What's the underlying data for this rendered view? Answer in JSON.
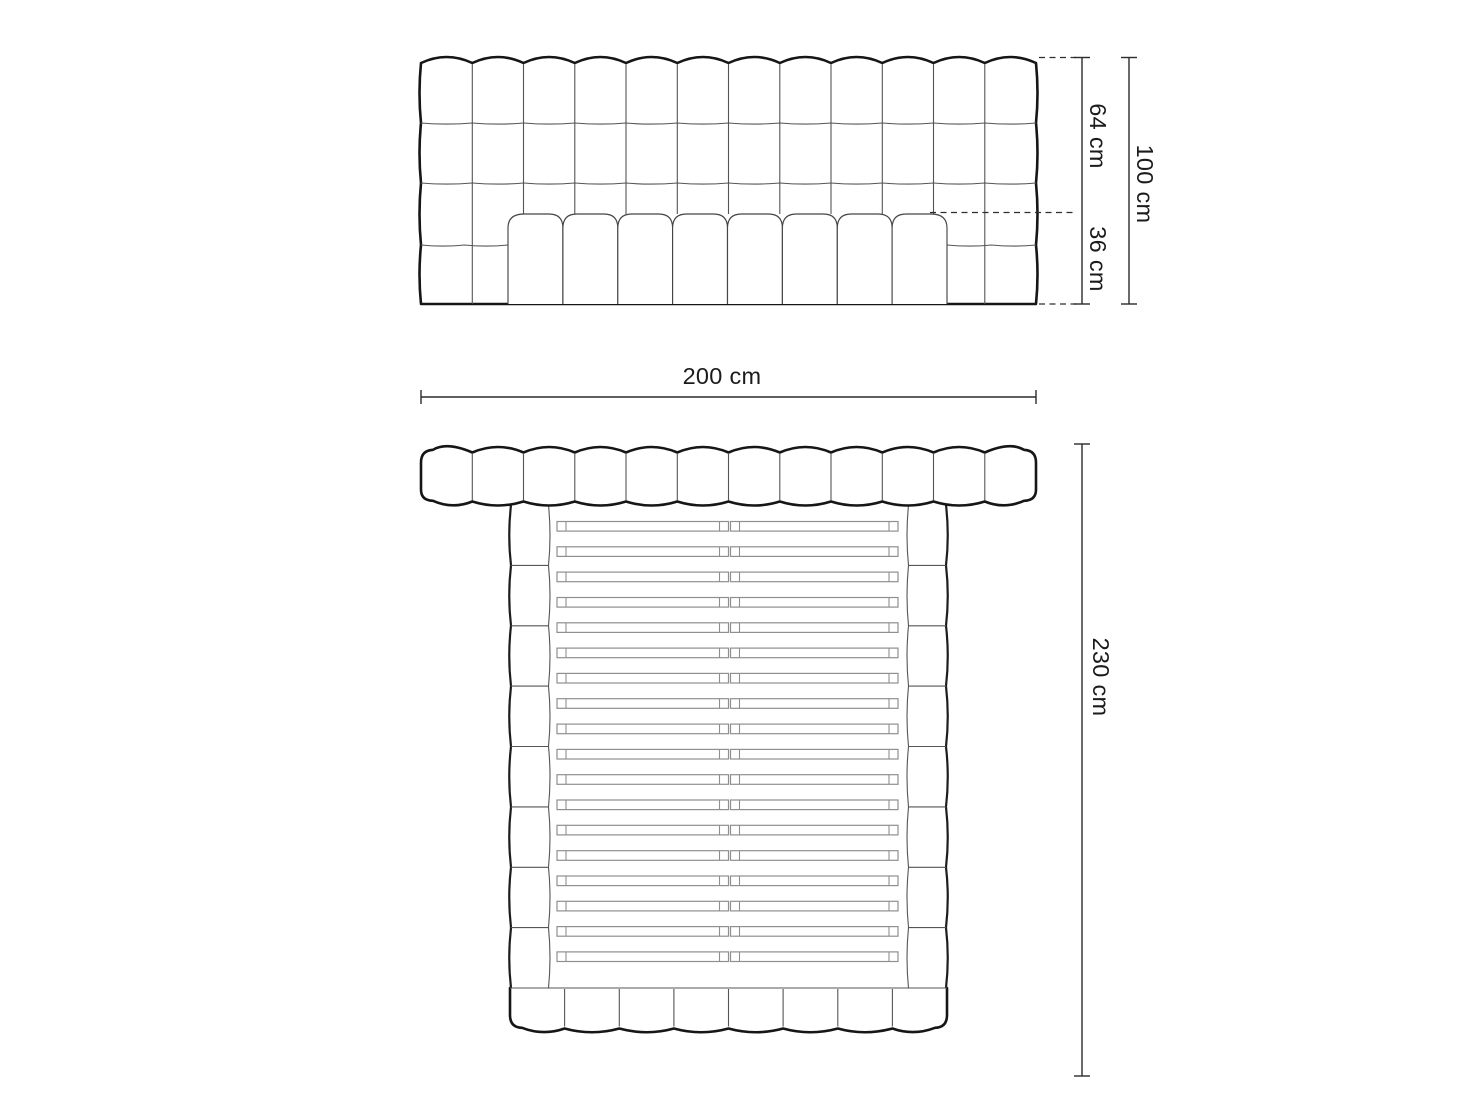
{
  "labels": {
    "headboard_upper_height": "64 cm",
    "mattress_height": "36 cm",
    "total_height": "100 cm",
    "total_width": "200 cm",
    "total_length": "230 cm"
  },
  "figure": {
    "colors": {
      "outline": "#161616",
      "grid": "#555555",
      "slat": "#8f8f8f",
      "dimension": "#2b2b2b"
    },
    "front": {
      "left": 421,
      "right": 1036,
      "top_peak": 57,
      "top_dip": 63,
      "bottom": 304,
      "cols": 12,
      "row_lines": [
        123,
        183,
        245
      ]
    },
    "mattress": {
      "left": 508,
      "right": 947,
      "top": 214,
      "bottom": 304,
      "segments": 8,
      "corner": 14,
      "corner_outer": 16
    },
    "front_dims": {
      "line_a_x": 1082,
      "line_b_x": 1129,
      "y_top": 57.5,
      "y_mid": 212.5,
      "y_bottom": 304,
      "dash_top_x1": 1039,
      "dash_mid_x1": 930,
      "dash_x2": 1076,
      "tick": 8
    },
    "dim200": {
      "y": 397,
      "x1": 421,
      "x2": 1036,
      "tick": 7
    },
    "top_band": {
      "left": 421,
      "right": 1036,
      "peak": 447,
      "dip": 452.5,
      "bottom": 500.5,
      "sag": 9,
      "cols": 12
    },
    "frame": {
      "left": 510,
      "right": 947,
      "rail_outer_l": 511,
      "rail_inner_l": 548.5,
      "rail_outer_r": 946,
      "rail_inner_r": 908.5,
      "top": 505,
      "bottom": 988,
      "segments": 8
    },
    "footboard": {
      "left": 510,
      "right": 947,
      "top": 988,
      "bottom": 1027.5,
      "sag": 8.5,
      "segments": 8
    },
    "slats": {
      "rows": 18,
      "top": 521.5,
      "pitch": 25.32,
      "h": 9.6,
      "cap": 9,
      "left": [
        557,
        728.5
      ],
      "right": [
        730.5,
        898
      ]
    },
    "dim230": {
      "x": 1082,
      "y1": 444,
      "y2": 1076,
      "tick": 8,
      "label_x": 1101,
      "label_y": 677
    }
  }
}
